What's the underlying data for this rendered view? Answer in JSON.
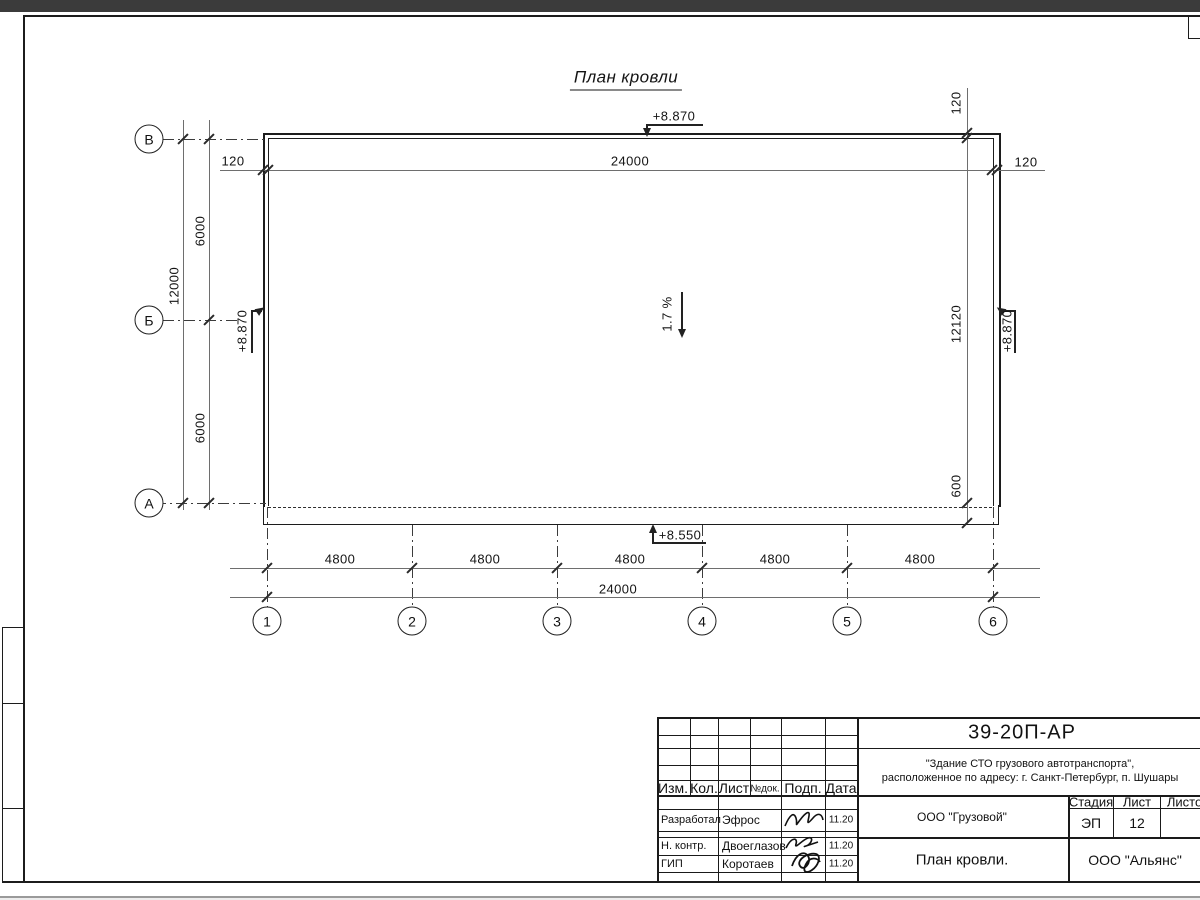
{
  "drawing": {
    "title": "План кровли",
    "slope_label": "1.7 %",
    "elevation_top": "+8.870",
    "elevation_left": "+8.870",
    "elevation_right": "+8.870",
    "elevation_bottom": "+8.550",
    "dims": {
      "top_total": "24000",
      "offset_top_left": "120",
      "offset_top_right": "120",
      "offset_top_right_vert": "120",
      "left_total": "12000",
      "left_segments": [
        "6000",
        "6000"
      ],
      "right_height": "12120",
      "right_overhang": "600",
      "bottom_segments": [
        "4800",
        "4800",
        "4800",
        "4800",
        "4800"
      ],
      "bottom_total": "24000"
    },
    "row_axes": [
      "В",
      "Б",
      "А"
    ],
    "col_axes": [
      "1",
      "2",
      "3",
      "4",
      "5",
      "6"
    ]
  },
  "titleblock": {
    "doc_number": "39-20П-АР",
    "project_line1": "\"Здание СТО грузового автотранспорта\",",
    "project_line2": "расположенное по адресу: г. Санкт-Петербург, п. Шушары",
    "header_cols": [
      "Изм.",
      "Кол.",
      "Лист",
      "№док.",
      "Подп.",
      "Дата"
    ],
    "rows": [
      {
        "role": "Разработал",
        "name": "Эфрос",
        "date": "11.20"
      },
      {
        "role": "Н. контр.",
        "name": "Двоеглазов",
        "date": "11.20"
      },
      {
        "role": "ГИП",
        "name": "Коротаев",
        "date": "11.20"
      }
    ],
    "org1": "ООО \"Грузовой\"",
    "stage_label": "Стадия",
    "sheet_label": "Лист",
    "sheets_label": "Листов",
    "stage_value": "ЭП",
    "sheet_value": "12",
    "drawing_name": "План кровли.",
    "org2": "ООО \"Альянс\""
  }
}
